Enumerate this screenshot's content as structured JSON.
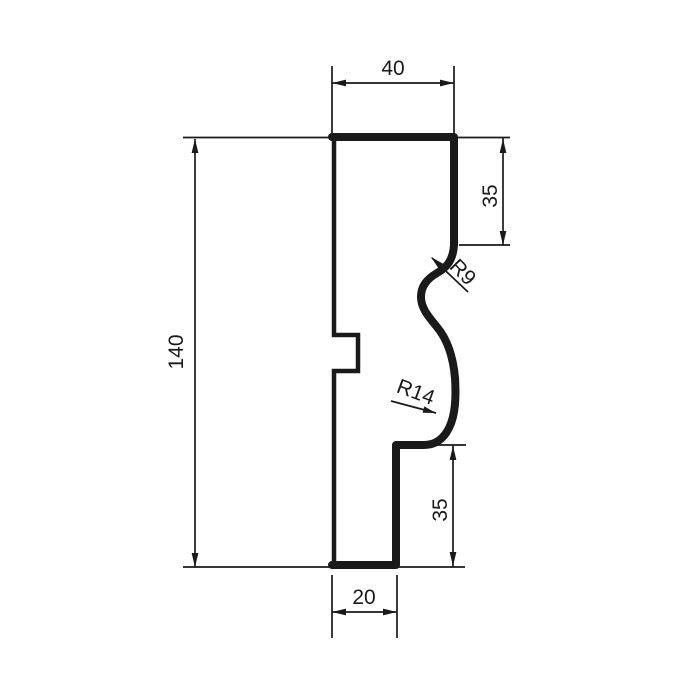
{
  "drawing": {
    "type": "molding-profile-cross-section",
    "background_color": "#ffffff",
    "line_color": "#1a1a1a",
    "dimensions": {
      "top_width": {
        "label": "40",
        "orientation": "horizontal"
      },
      "upper_right_height": {
        "label": "35",
        "orientation": "vertical"
      },
      "upper_radius": {
        "label": "R9",
        "orientation": "diagonal-45"
      },
      "overall_height": {
        "label": "140",
        "orientation": "vertical"
      },
      "lower_radius": {
        "label": "R14",
        "orientation": "diagonal-20"
      },
      "lower_right_height": {
        "label": "35",
        "orientation": "vertical"
      },
      "bottom_width": {
        "label": "20",
        "orientation": "horizontal"
      }
    }
  }
}
